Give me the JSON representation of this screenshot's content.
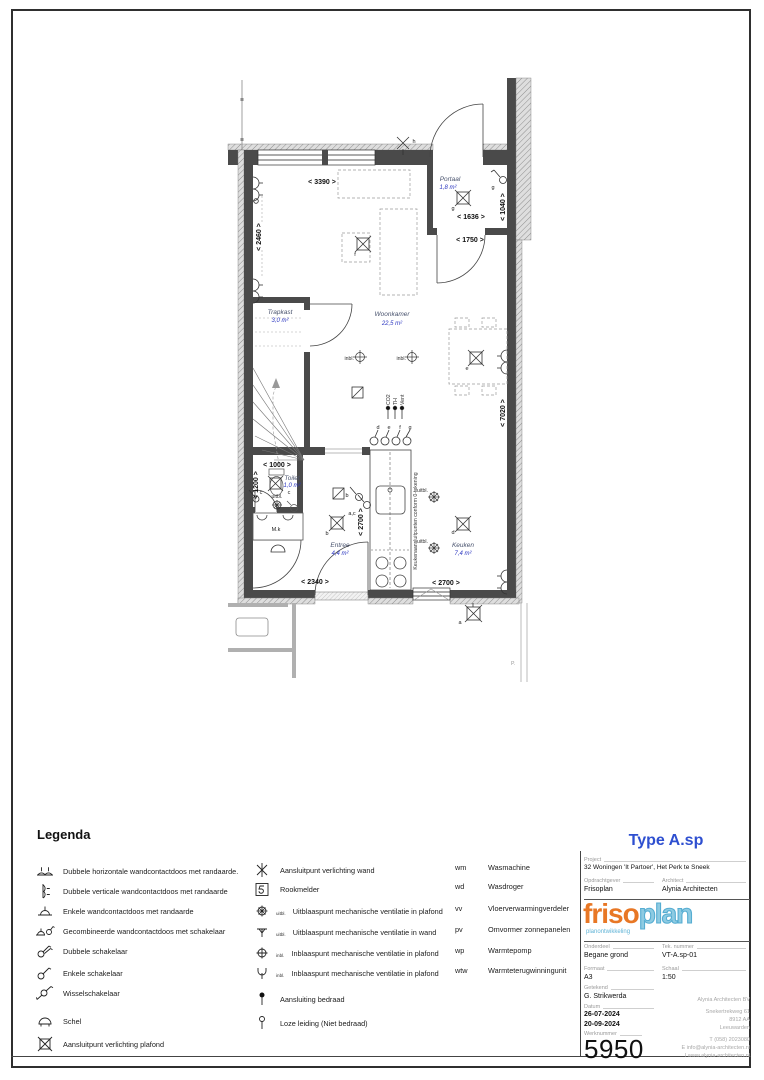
{
  "plan": {
    "rooms": {
      "portaal": {
        "name": "Portaal",
        "area": "1,8 m²"
      },
      "woonkamer": {
        "name": "Woonkamer",
        "area": "22,5 m²"
      },
      "trapkast": {
        "name": "Trapkast",
        "area": "3,0 m²"
      },
      "toilet": {
        "name": "Toilet",
        "area": "1,0 m²"
      },
      "entree": {
        "name": "Entree",
        "area": "4,4 m²"
      },
      "keuken": {
        "name": "Keuken",
        "area": "7,4 m²"
      },
      "meterkast": "M.k"
    },
    "dims": {
      "woonkamer_w": "< 3390 >",
      "woonkamer_window_h": "< 2460 >",
      "portaal_w": "< 1636 >",
      "hal_w": "< 1750 >",
      "portaal_h": "< 1040 >",
      "depth": "< 7020 >",
      "toilet_w": "< 1000 >",
      "toilet_h": "< 1200 >",
      "counter_h": "< 2700 >",
      "entree_w": "< 2340 >",
      "keuken_w": "< 2700 >"
    },
    "notes": {
      "kitchen": "Keukenaansluitpunten conform 0-tekening",
      "co2": "CO2",
      "th": "TH",
      "vent": "Vent",
      "inbl": "inbl.",
      "uitbl": "uitbl.",
      "corner_mark": "P."
    },
    "letters": {
      "a": "a",
      "b": "b",
      "c": "c",
      "d": "d",
      "e": "e",
      "f": "f",
      "g": "g",
      "h": "h",
      "ac": "a,c"
    }
  },
  "legend": {
    "title": "Legenda",
    "sub": {
      "uitbl": "uitbl.",
      "inbl": "inbl."
    },
    "col1": [
      "Dubbele horizontale wandcontactdoos met randaarde.",
      "Dubbele verticale wandcontactdoos met randaarde",
      "Enkele wandcontactdoos met randaarde",
      "Gecombineerde wandcontactdoos met schakelaar",
      "Dubbele schakelaar",
      "Enkele schakelaar",
      "Wisselschakelaar",
      "Schel",
      "Aansluitpunt verlichting plafond"
    ],
    "col2": [
      "Aansluitpunt verlichting wand",
      "Rookmelder",
      "Uitblaaspunt mechanische ventilatie in plafond",
      "Uitblaaspunt mechanische ventilatie in wand",
      "Inblaaspunt mechanische ventilatie in plafond",
      "Inblaaspunt mechanische ventilatie in plafond",
      "Aansluiting bedraad",
      "Loze leiding (Niet bedraad)"
    ],
    "col3": [
      {
        "abbr": "wm",
        "label": "Wasmachine"
      },
      {
        "abbr": "wd",
        "label": "Wasdroger"
      },
      {
        "abbr": "vv",
        "label": "Vloerverwarmingverdeler"
      },
      {
        "abbr": "pv",
        "label": "Omvormer zonnepanelen"
      },
      {
        "abbr": "wp",
        "label": "Warmtepomp"
      },
      {
        "abbr": "wtw",
        "label": "Warmteterugwinningunit"
      }
    ]
  },
  "titleblock": {
    "type": "Type A.sp",
    "project_label": "Project",
    "project": "32 Woningen 'It Partoer', Het Perk te Sneek",
    "client_label": "Opdrachtgever",
    "client": "Frisoplan",
    "architect_label": "Architect",
    "architect": "Alynia Architecten",
    "logo": {
      "part1": "friso",
      "part2": "plan",
      "tagline": "planontwikkeling"
    },
    "onderdeel_label": "Onderdeel",
    "onderdeel": "Begane grond",
    "teknr_label": "Tek. nummer",
    "teknr": "VT-A.sp-01",
    "formaat_label": "Formaat",
    "formaat": "A3",
    "schaal_label": "Schaal",
    "schaal": "1:50",
    "getekend_label": "Getekend",
    "getekend": "G. Strikwerda",
    "datum_label": "Datum",
    "datum1": "26-07-2024",
    "datum2": "20-09-2024",
    "werknummer_label": "Werknummer",
    "werknummer": "5950",
    "address": {
      "name": "Alynia Architecten BV",
      "street": "Snekertrekweg 61",
      "zip": "8912 AA",
      "city": "Leeuwarden",
      "phone": "T (058) 2023080",
      "email": "E info@alynia-architecten.nl",
      "web": "I www.alynia-architecten.nl"
    },
    "colors": {
      "accent_blue": "#2e4fd0",
      "logo_orange": "#e87725",
      "logo_blue": "#7cc3de",
      "area_blue": "#2b36c0"
    }
  }
}
